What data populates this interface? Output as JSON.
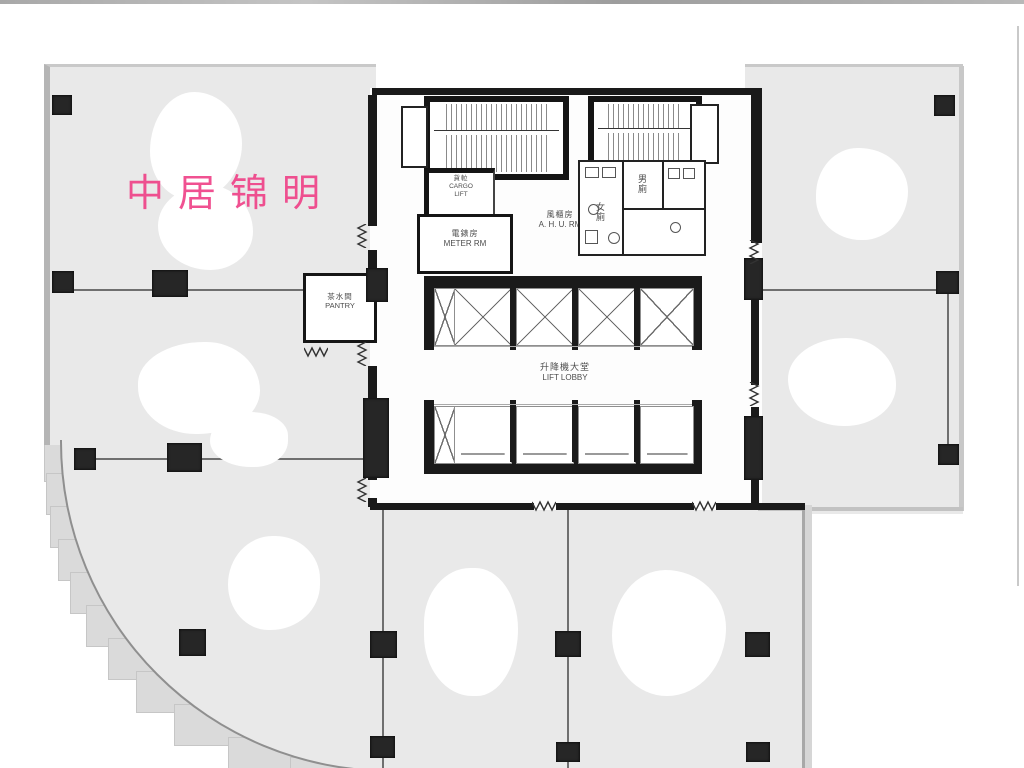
{
  "watermark": {
    "text": "中居锦明",
    "color": "#ef3f86"
  },
  "labels": {
    "pantry_zh": "茶水間",
    "pantry_en": "PANTRY",
    "meter_zh": "電錶房",
    "meter_en": "METER RM",
    "cargo_zh": "貨𨋢",
    "cargo_en1": "CARGO",
    "cargo_en2": "LIFT",
    "ahu_zh": "風櫃房",
    "ahu_en": "A. H. U. RM",
    "lobby_zh": "升降機大堂",
    "lobby_en": "LIFT LOBBY",
    "toilet_female_zh": "女廁",
    "toilet_male_zh": "男廁"
  },
  "colors": {
    "floor_gray": "#e9e9e9",
    "wall_black": "#1a1a1a",
    "watermark_pink": "#ef3f86"
  }
}
